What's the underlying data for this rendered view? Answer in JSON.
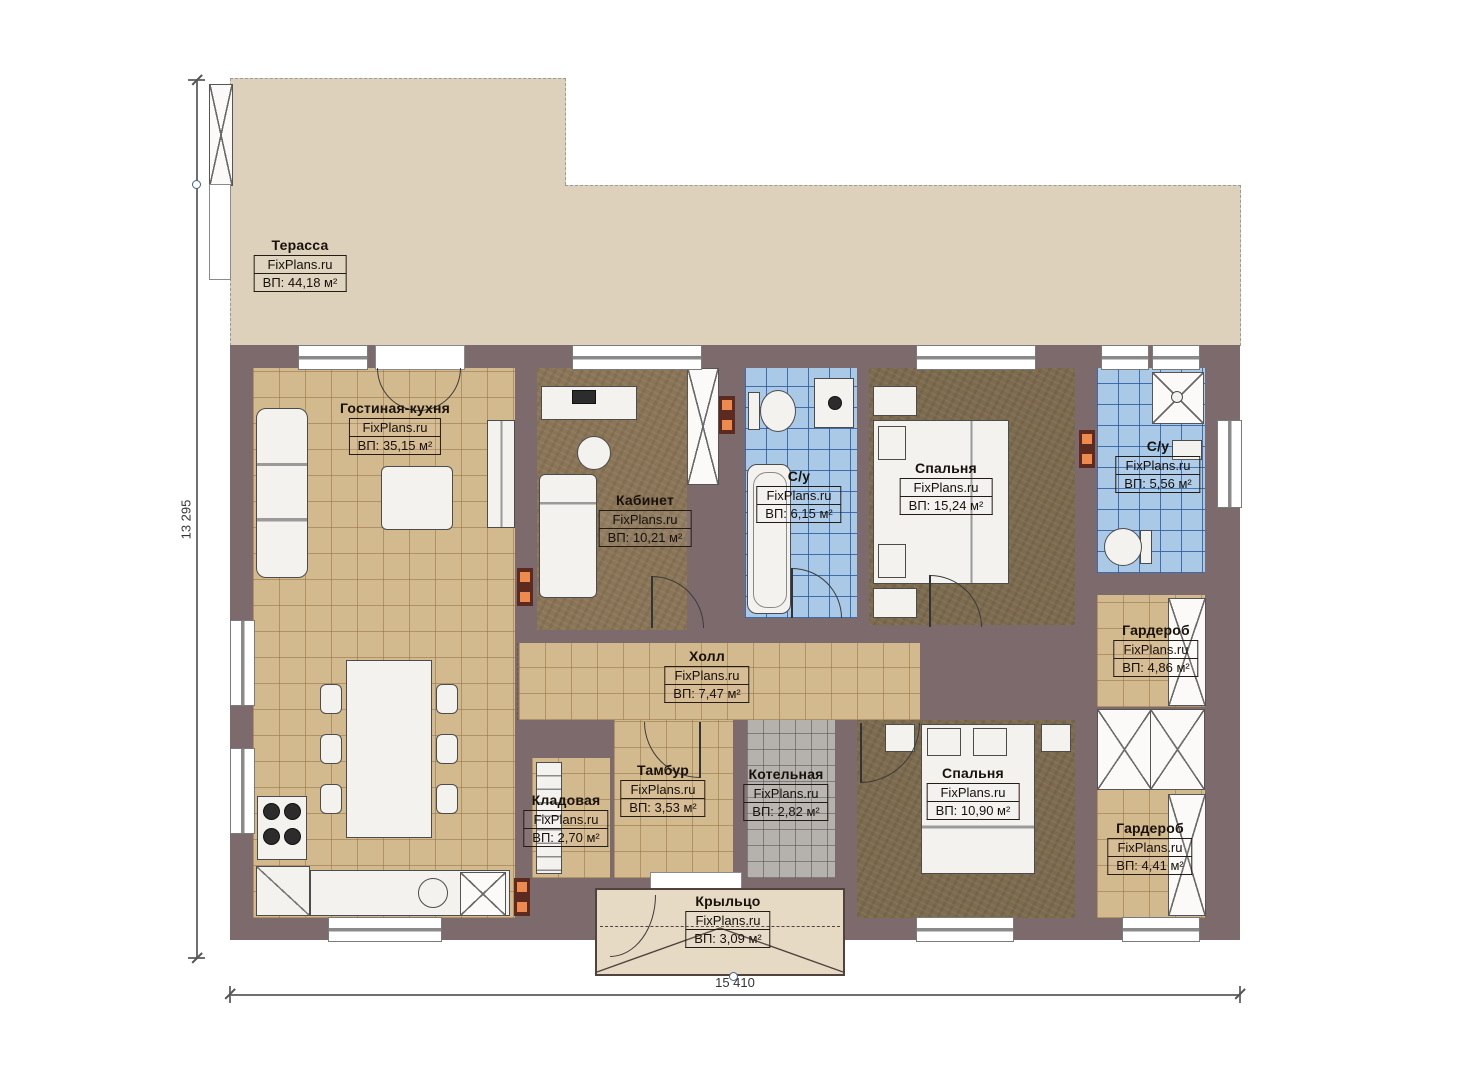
{
  "watermark": "FixPlans.ru",
  "dimensions": {
    "height_label": "13 295",
    "width_label": "15 410"
  },
  "rooms": [
    {
      "id": "terrace",
      "name": "Терасса",
      "area": "ВП: 44,18 м²"
    },
    {
      "id": "living",
      "name": "Гостиная-кухня",
      "area": "ВП: 35,15 м²"
    },
    {
      "id": "office",
      "name": "Кабинет",
      "area": "ВП: 10,21 м²"
    },
    {
      "id": "bath1",
      "name": "С/у",
      "area": "ВП: 6,15 м²"
    },
    {
      "id": "bedroom1",
      "name": "Спальня",
      "area": "ВП: 15,24 м²"
    },
    {
      "id": "bath2",
      "name": "С/у",
      "area": "ВП: 5,56 м²"
    },
    {
      "id": "wardrobe1",
      "name": "Гардероб",
      "area": "ВП: 4,86 м²"
    },
    {
      "id": "hall",
      "name": "Холл",
      "area": "ВП: 7,47 м²"
    },
    {
      "id": "vestibule",
      "name": "Тамбур",
      "area": "ВП: 3,53 м²"
    },
    {
      "id": "boiler",
      "name": "Котельная",
      "area": "ВП: 2,82 м²"
    },
    {
      "id": "pantry",
      "name": "Кладовая",
      "area": "ВП: 2,70 м²"
    },
    {
      "id": "bedroom2",
      "name": "Спальня",
      "area": "ВП: 10,90 м²"
    },
    {
      "id": "wardrobe2",
      "name": "Гардероб",
      "area": "ВП: 4,41 м²"
    },
    {
      "id": "porch",
      "name": "Крыльцо",
      "area": "ВП: 3,09 м²"
    }
  ],
  "colors": {
    "wall": "#7d6a6d",
    "floor_wood": "#d3b98e",
    "floor_dark": "#7c6b4e",
    "tile_blue": "#a9c9e7",
    "tile_gray": "#b5b2ae",
    "terrace": "#ddd1bc",
    "porch": "#e6dac5",
    "vent_orange": "#ef8a4e"
  }
}
